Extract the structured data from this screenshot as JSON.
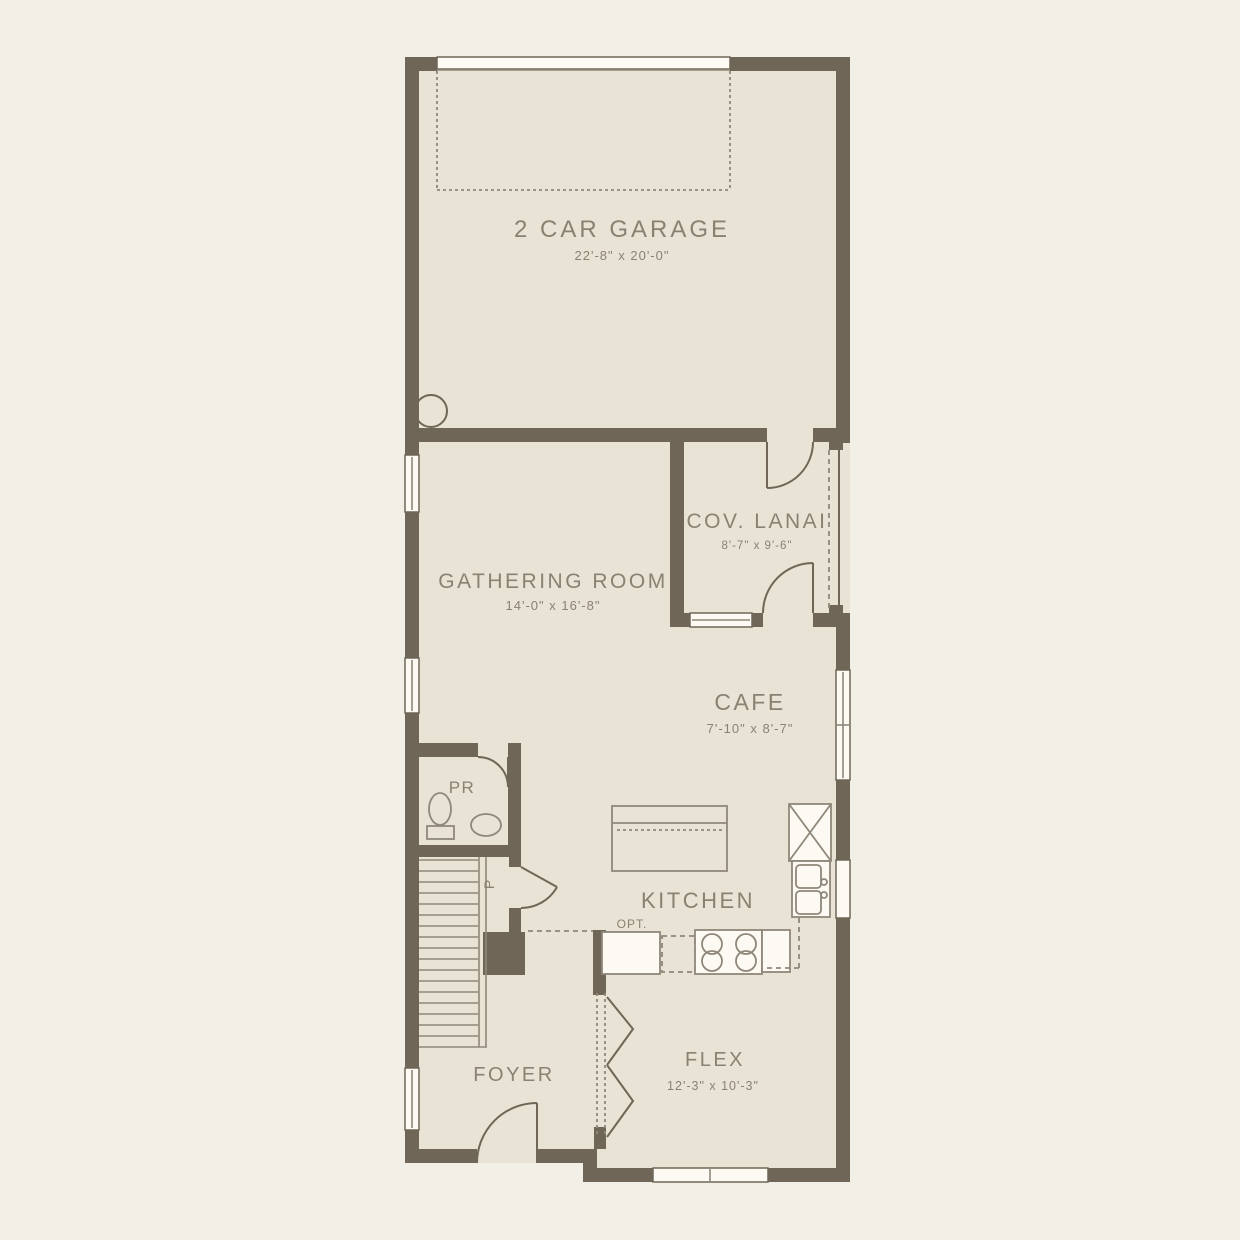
{
  "rooms": {
    "garage": {
      "label": "2 CAR GARAGE",
      "dims": "22'-8\" x 20'-0\""
    },
    "lanai": {
      "label": "COV. LANAI",
      "dims": "8'-7\" x 9'-6\""
    },
    "gathering": {
      "label": "GATHERING ROOM",
      "dims": "14'-0\" x 16'-8\""
    },
    "cafe": {
      "label": "CAFE",
      "dims": "7'-10\" x 8'-7\""
    },
    "kitchen": {
      "label": "KITCHEN"
    },
    "flex": {
      "label": "FLEX",
      "dims": "12'-3\" x 10'-3\""
    },
    "foyer": {
      "label": "FOYER"
    },
    "powder_room": {
      "label": "PR"
    },
    "pantry": {
      "label": "P"
    },
    "kitchen_option": {
      "label": "OPT."
    }
  },
  "colors": {
    "background": "#f2efe6",
    "floor": "#e8e3d5",
    "wall": "#6f6657",
    "window": "#fcfaf3",
    "text": "#8a8173",
    "fixture": "#8f8779"
  }
}
